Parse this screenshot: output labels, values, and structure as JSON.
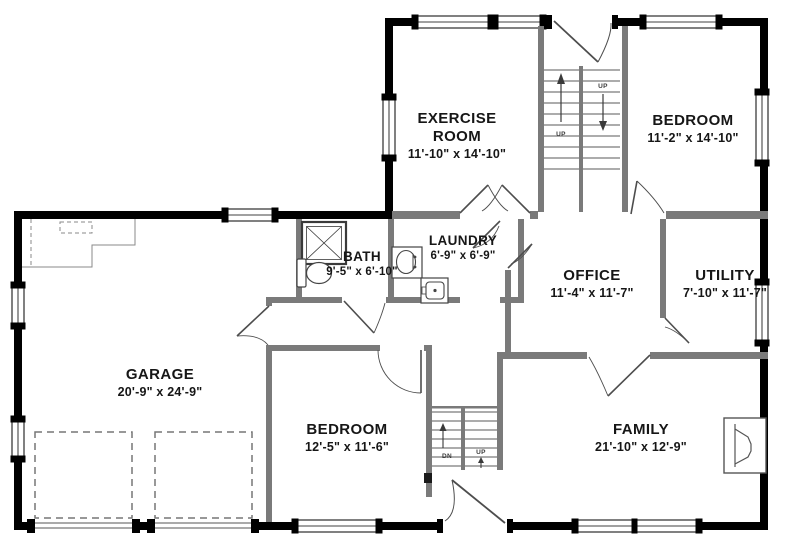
{
  "plan": {
    "title": "first-floor-plan",
    "rooms": [
      {
        "id": "exercise-room",
        "name": "EXERCISE ROOM",
        "dims": "11'-10\" x 14'-10\""
      },
      {
        "id": "bedroom-upper",
        "name": "BEDROOM",
        "dims": "11'-2\" x 14'-10\""
      },
      {
        "id": "bath",
        "name": "BATH",
        "dims": "9'-5\" x 6'-10\""
      },
      {
        "id": "laundry",
        "name": "LAUNDRY",
        "dims": "6'-9\" x 6'-9\""
      },
      {
        "id": "office",
        "name": "OFFICE",
        "dims": "11'-4\" x 11'-7\""
      },
      {
        "id": "utility",
        "name": "UTILITY",
        "dims": "7'-10\" x 11'-7\""
      },
      {
        "id": "garage",
        "name": "GARAGE",
        "dims": "20'-9\" x 24'-9\""
      },
      {
        "id": "bedroom-lower",
        "name": "BEDROOM",
        "dims": "12'-5\" x 11'-6\""
      },
      {
        "id": "family",
        "name": "FAMILY",
        "dims": "21'-10\" x 12'-9\""
      }
    ],
    "stair_labels": {
      "up": "UP",
      "dn": "DN"
    },
    "colors": {
      "exterior_wall": "#000000",
      "interior_wall": "#7a7a7a",
      "fixture_stroke": "#4d4d4d",
      "background": "#ffffff",
      "label_text": "#161616"
    }
  }
}
